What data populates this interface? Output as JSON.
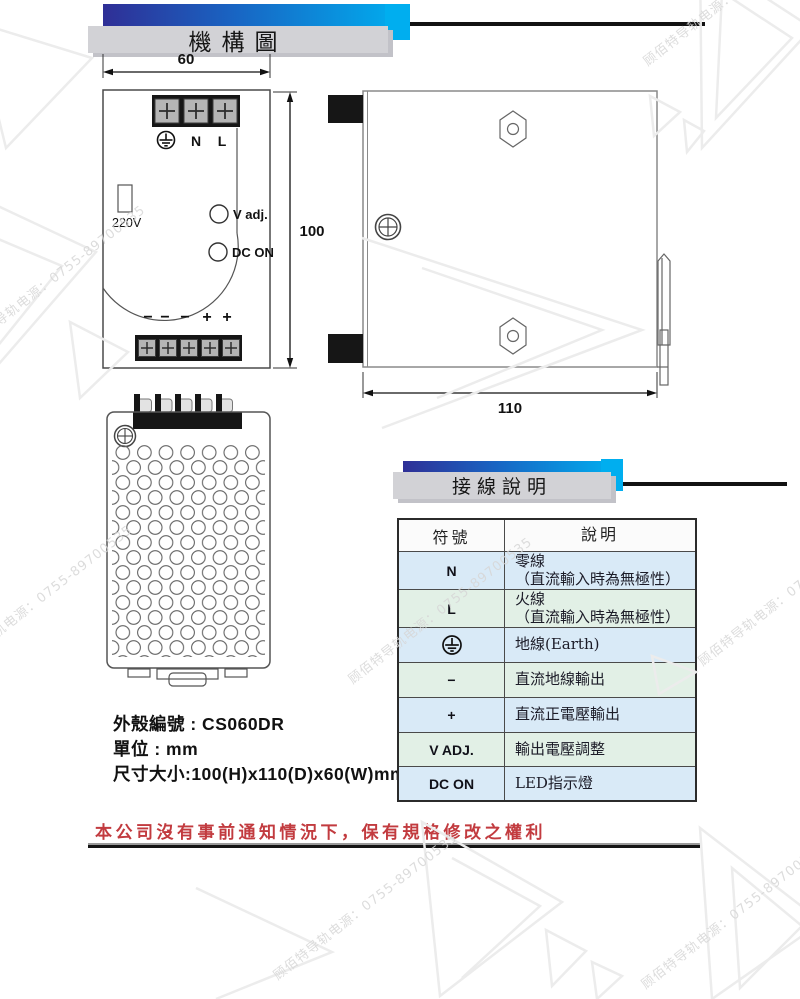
{
  "watermark": {
    "text": "顾佰特导轨电源：0755-89700535"
  },
  "banner_mechanism": {
    "title": "機構圖"
  },
  "banner_wiring": {
    "title": "接線說明"
  },
  "front_view": {
    "dim_width": "60",
    "dim_height": "100",
    "label_n": "N",
    "label_l": "L",
    "label_voltage": "220V",
    "label_vadj": "V adj.",
    "label_dcon": "DC ON",
    "polarity": [
      "−",
      "−",
      "−",
      "+",
      "+"
    ]
  },
  "side_view": {
    "dim_depth": "110"
  },
  "specs": {
    "case_no": "外殼編號 : CS060DR",
    "unit": "單位 : mm",
    "size": "尺寸大小:100(H)x110(D)x60(W)mm"
  },
  "wiring_table": {
    "header_symbol": "符號",
    "header_desc": "說明",
    "rows": [
      {
        "symbol": "N",
        "desc1": "零線",
        "desc2": "（直流輸入時為無極性）"
      },
      {
        "symbol": "L",
        "desc1": "火線",
        "desc2": "（直流輸入時為無極性）"
      },
      {
        "symbol": "earth",
        "desc1": "地線(Earth)",
        "desc2": ""
      },
      {
        "symbol": "−",
        "desc1": "直流地線輸出",
        "desc2": ""
      },
      {
        "symbol": "+",
        "desc1": "直流正電壓輸出",
        "desc2": ""
      },
      {
        "symbol": "V ADJ.",
        "desc1": "輸出電壓調整",
        "desc2": ""
      },
      {
        "symbol": "DC ON",
        "desc1": "LED指示燈",
        "desc2": ""
      }
    ]
  },
  "footer": {
    "notice": "本公司沒有事前通知情況下，保有規格修改之權利"
  },
  "colors": {
    "accent_cyan": "#00aeef",
    "gradient_start": "#2f2f96",
    "gradient_mid": "#1866c4",
    "row_blue": "#d9eaf7",
    "row_green": "#e2f0e6",
    "notice_red": "#c23b3f",
    "banner_gray": "#d2d2d6"
  }
}
